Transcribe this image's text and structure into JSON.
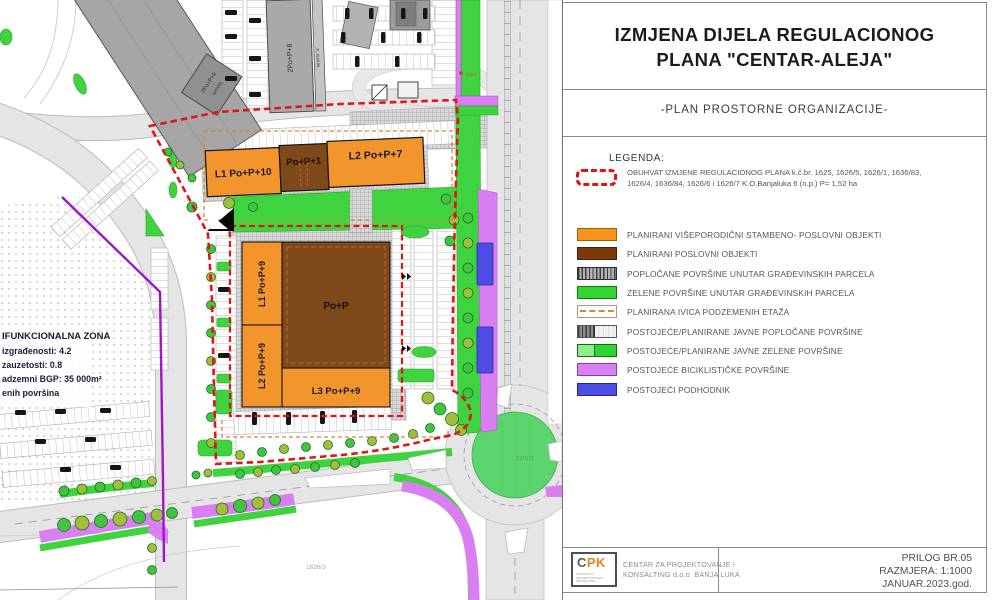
{
  "panel": {
    "title": {
      "line1": "IZMJENA DIJELA REGULACIONOG",
      "line2": "PLANA \"CENTAR-ALEJA\""
    },
    "subtitle": "-PLAN PROSTORNE ORGANIZACIJE-",
    "legend": {
      "heading": "LEGENDA:",
      "obuhvat_line1": "OBUHVAT  IZMJENE REGULACIONOG PLANA k.č.br. 1625, 1626/5, 1626/1, 1636/83,",
      "obuhvat_line2": "1626/4, 1636/84, 1626/6 i 1626/7 K.O.Banjaluka 6 (n.p.) P= 1,52 ha",
      "items": [
        {
          "label": "PLANIRANI VIŠEPORODIČNI STAMBENO- POSLOVNI OBJEKTI",
          "color": "#F7941E"
        },
        {
          "label": "PLANIRANI POSLOVNI OBJEKTI",
          "color": "#7A3A0E"
        },
        {
          "label": "POPLOČANE POVRŠINE UNUTAR GRAĐEVINSKIH PARCELA",
          "color": "hatch-gray"
        },
        {
          "label": "ZELENE POVRŠINE UNUTAR GRAĐEVINSKIH PARCELA",
          "color": "#35D435"
        },
        {
          "label": "PLANIRANA IVICA PODZEMENIH ETAŽA",
          "color": "#D08A30"
        },
        {
          "label": "POSTOJEĆE/PLANIRANE JAVNE POPLOČANE POVRŠINE",
          "color": "hatch-half"
        },
        {
          "label": "POSTOJEĆE/PLANIRANE JAVNE ZELENE POVRŠINE",
          "color": "#2FD42F"
        },
        {
          "label": "POSTOJEĆE BICIKLISTIČKE POVRŠINE",
          "color": "#D87FF2"
        },
        {
          "label": "POSTOJEĆI PODHODNIK",
          "color": "#4D4DE3"
        }
      ]
    },
    "footer": {
      "logo_c": "C",
      "logo_pk": "PK",
      "logo_sub": "CENTAR ZA PROJEKTOVANJE I KONSALTING",
      "company_line1": "CENTAR ZA PROJEKTOVANJE I",
      "company_line2": "KONSALTING d.o.o. BANJA LUKA",
      "prilog": "PRILOG BR.05",
      "razmjera": "RAZMJERA: 1:1000",
      "datum": "JANUAR.2023.god."
    }
  },
  "map": {
    "buildings": {
      "top_l1": "L1 Po+P+10",
      "top_mid": "Po+P+1",
      "top_l2": "L2 Po+P+7",
      "c_l1": "L1 Po+P+9",
      "c_l2": "L2 Po+P+9",
      "c_l3": "L3 Po+P+9",
      "c_main": "Po+P",
      "ex_a": "2Po+P+8",
      "ex_a2": "lamela \"a\"",
      "ex_b": "2Po+P+9",
      "ex_b2": "lamela"
    },
    "zone": [
      "IFUNKCIONALNA ZONA",
      "izgrađenosti: 4.2",
      "zauzetosti: 0.8",
      "adzemni BGP: 35 000m²",
      "enih površina"
    ],
    "parcels": {
      "p1": "1626/3",
      "p2": "2201/1"
    },
    "annotation": "136.5",
    "colors": {
      "boundary_red": "#E01515",
      "underground_orange": "#D08A30",
      "zone_purple": "#A015C8",
      "green": "#3FD43F",
      "bike_magenta": "#D97FF2",
      "underpass_blue": "#4D4DE3",
      "building_orange": "#F2952D",
      "building_brown": "#7E4A1C"
    }
  }
}
